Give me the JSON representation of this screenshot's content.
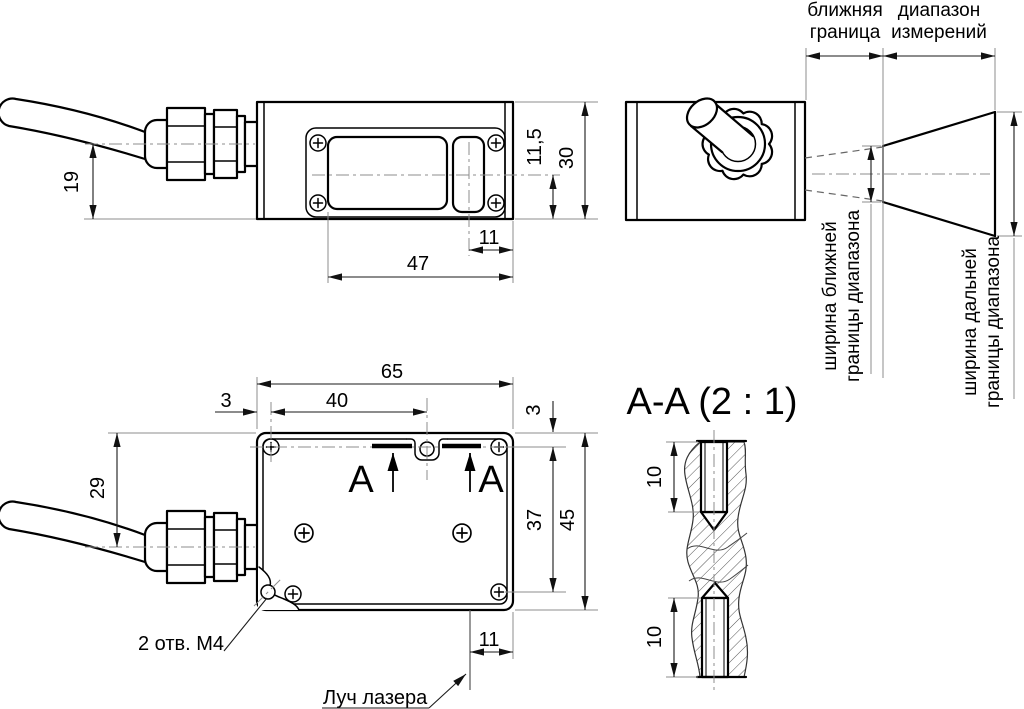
{
  "drawing_type": "technical-dimension-drawing",
  "colors": {
    "line": "#000000",
    "dimension": "#1a1a1a",
    "auxiliary": "#8c8c8c",
    "background": "#ffffff"
  },
  "labels": {
    "near_boundary": [
      "ближняя",
      "граница"
    ],
    "range": [
      "диапазон",
      "измерений"
    ],
    "near_width": [
      "ширина ближней",
      "границы диапазона"
    ],
    "far_width": [
      "ширина дальней",
      "границы диапазона"
    ],
    "holes_note": "2 отв. М4",
    "laser_beam": "Луч лазера",
    "section_title": "A-A (2 : 1)",
    "section_letter": "A"
  },
  "dims": {
    "cable_axis_height": "19",
    "axis_to_bottom": "11,5",
    "body_height": "30",
    "window_to_edge": "11",
    "window_span": "47",
    "body_width": "65",
    "edge_to_screw": "3",
    "screw_to_hole": "40",
    "top_to_axis": "3",
    "top_to_cable": "29",
    "screw_rows": "37",
    "body_depth": "45",
    "beam_to_edge": "11",
    "thread_top": "10",
    "thread_bottom": "10"
  }
}
